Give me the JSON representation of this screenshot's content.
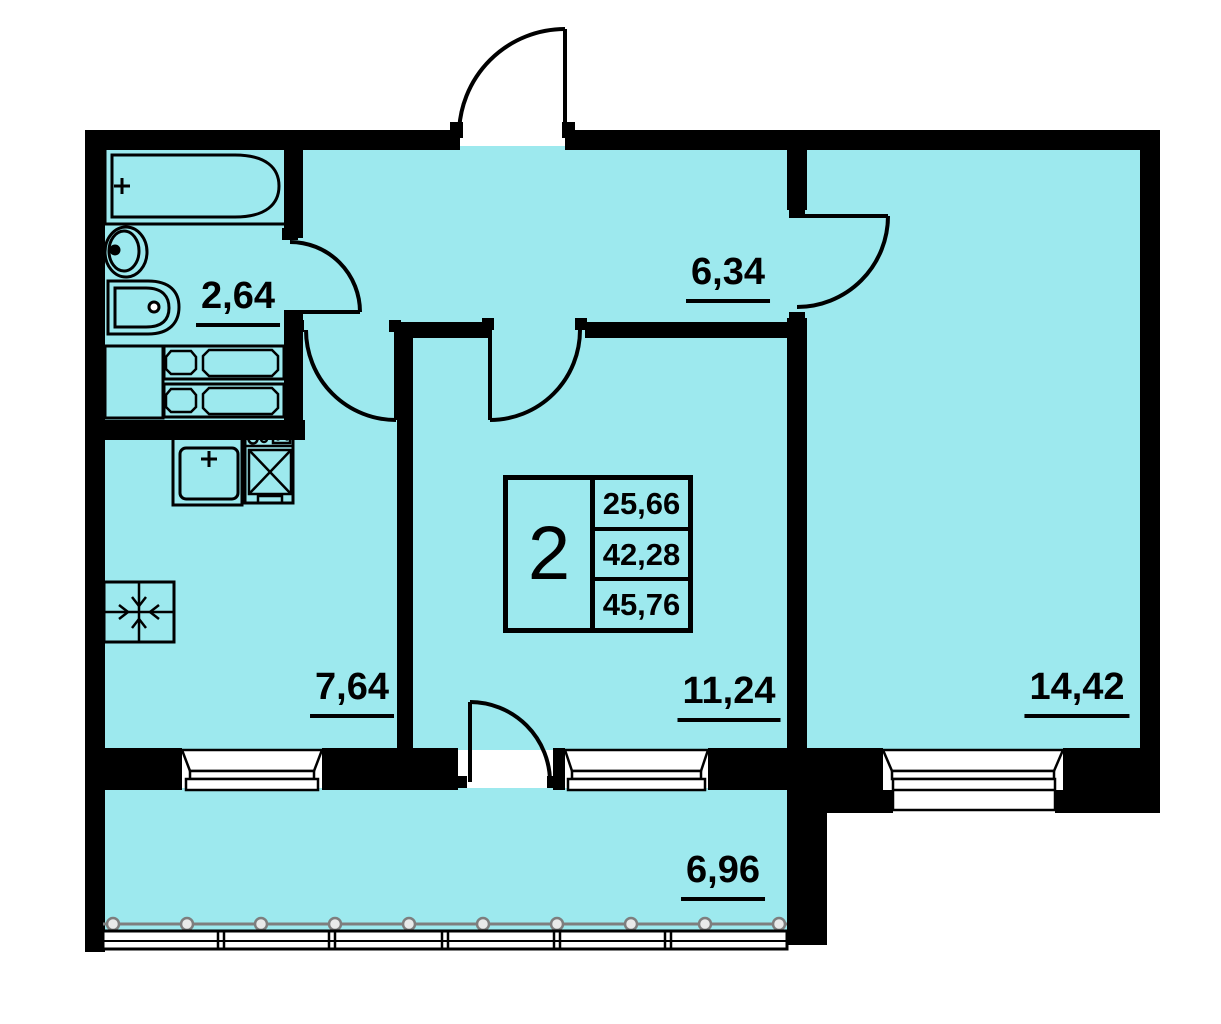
{
  "plan": {
    "info_box": {
      "rooms_count": "2",
      "living_area": "25,66",
      "apartment_area": "42,28",
      "total_area": "45,76"
    },
    "room_labels": {
      "bathroom": "2,64",
      "hallway": "6,34",
      "kitchen": "7,64",
      "living_room": "11,24",
      "bedroom": "14,42",
      "balcony": "6,96"
    },
    "colors": {
      "room_fill": "#9de9ee",
      "wall": "#000000",
      "background": "#ffffff",
      "glazing_gray": "#7e7e7e"
    }
  }
}
